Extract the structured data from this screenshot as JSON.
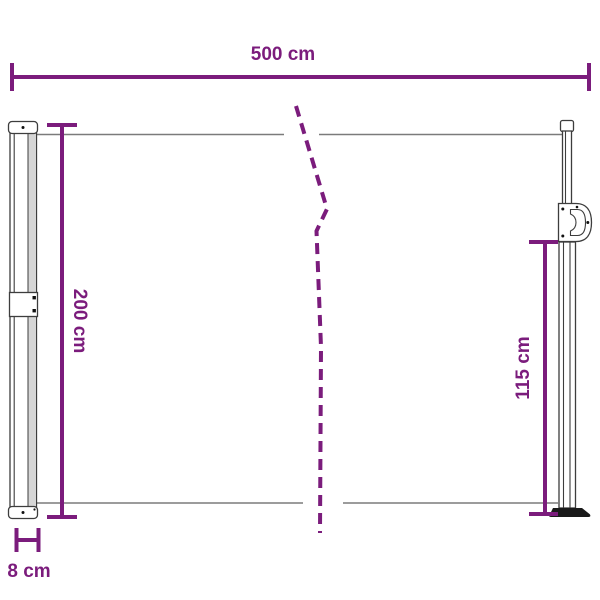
{
  "diagram": {
    "accent_color": "#7B1C7C",
    "edge_color": "#7b7b7b",
    "outline_color": "#3d3d3d",
    "base_color": "#1a1a1a",
    "labels": {
      "width": "500 cm",
      "height": "200 cm",
      "pole_height": "115 cm",
      "depth": "8 cm"
    }
  }
}
